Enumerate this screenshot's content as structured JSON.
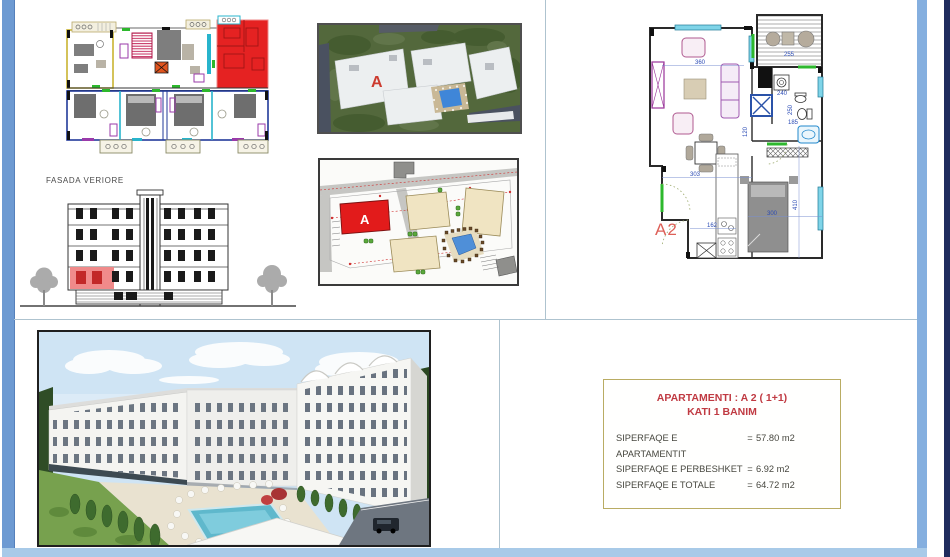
{
  "elevation": {
    "label": "FASADA VERIORE"
  },
  "aerial": {
    "building_label": "A"
  },
  "siteplan": {
    "building_label": "A"
  },
  "apartment": {
    "label": "A2",
    "dims": {
      "living_width": "360",
      "balcony_width": "255",
      "washer": "240",
      "hall": "120",
      "bath_height": "250",
      "bath_width": "185",
      "dining_width": "303",
      "kitchen": "162",
      "bed_width": "300",
      "bedroom_height": "410"
    }
  },
  "info_box": {
    "title_line1": "APARTAMENTI : A 2  ( 1+1)",
    "title_line2": "KATI 1 BANIM",
    "rows": [
      {
        "label": "SIPERFAQE E APARTAMENTIT",
        "eq": "=",
        "value": "57.80 m2"
      },
      {
        "label": "SIPERFAQE E PERBESHKET",
        "eq": "=",
        "value": "6.92  m2"
      },
      {
        "label": "SIPERFAQE E TOTALE",
        "eq": "=",
        "value": "64.72 m2"
      }
    ]
  },
  "colors": {
    "highlight_red": "#e52222",
    "title_red": "#c03a42",
    "info_border": "#b9ac63",
    "dim_blue": "#2b4bb5",
    "door_green": "#2db82d",
    "window_cyan": "#7fd4e8",
    "frame_blue": "#6d9ad2",
    "edge_navy": "#202c5e"
  }
}
